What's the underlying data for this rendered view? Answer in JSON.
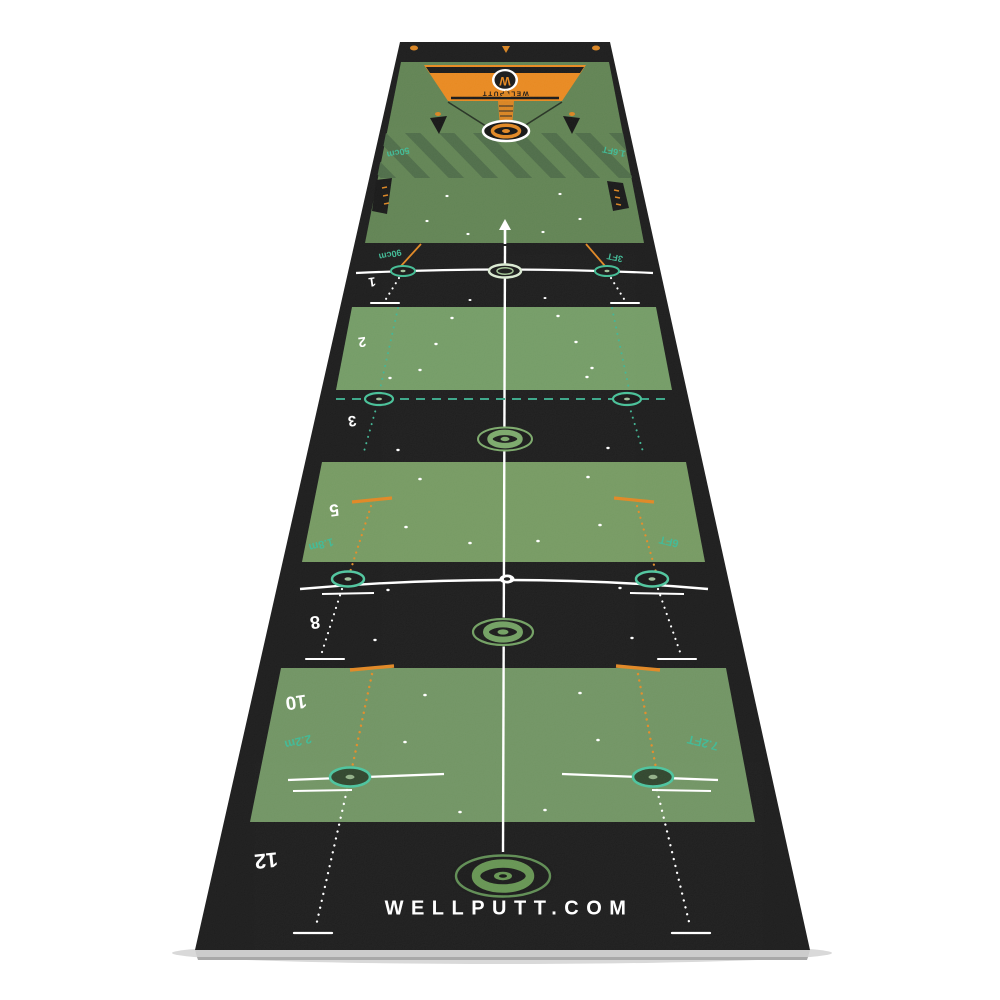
{
  "product": {
    "brand_url_text": "WELLPUTT.COM",
    "brand_name": "WELLPUTT",
    "logo_letter": "W"
  },
  "zone_numbers": [
    "1",
    "2",
    "3",
    "5",
    "8",
    "10",
    "12"
  ],
  "distance_labels": {
    "lag_zone_left": "50cm",
    "lag_zone_right": "1.6FT",
    "line_1_left": "90cm",
    "line_1_right": "3FT",
    "line_5_left": "1.8m",
    "line_5_right": "6FT",
    "line_10_left": "2.2m",
    "line_10_right": "7.2FT"
  },
  "colors": {
    "carpet_black": "#181818",
    "turf_green": "#6e9360",
    "turf_green_far": "#5e8150",
    "stripe_green": "#4b6a45",
    "accent_orange": "#e0851f",
    "accent_teal": "#3cb893",
    "line_white": "#ffffff",
    "bullseye_green": "#639457"
  }
}
